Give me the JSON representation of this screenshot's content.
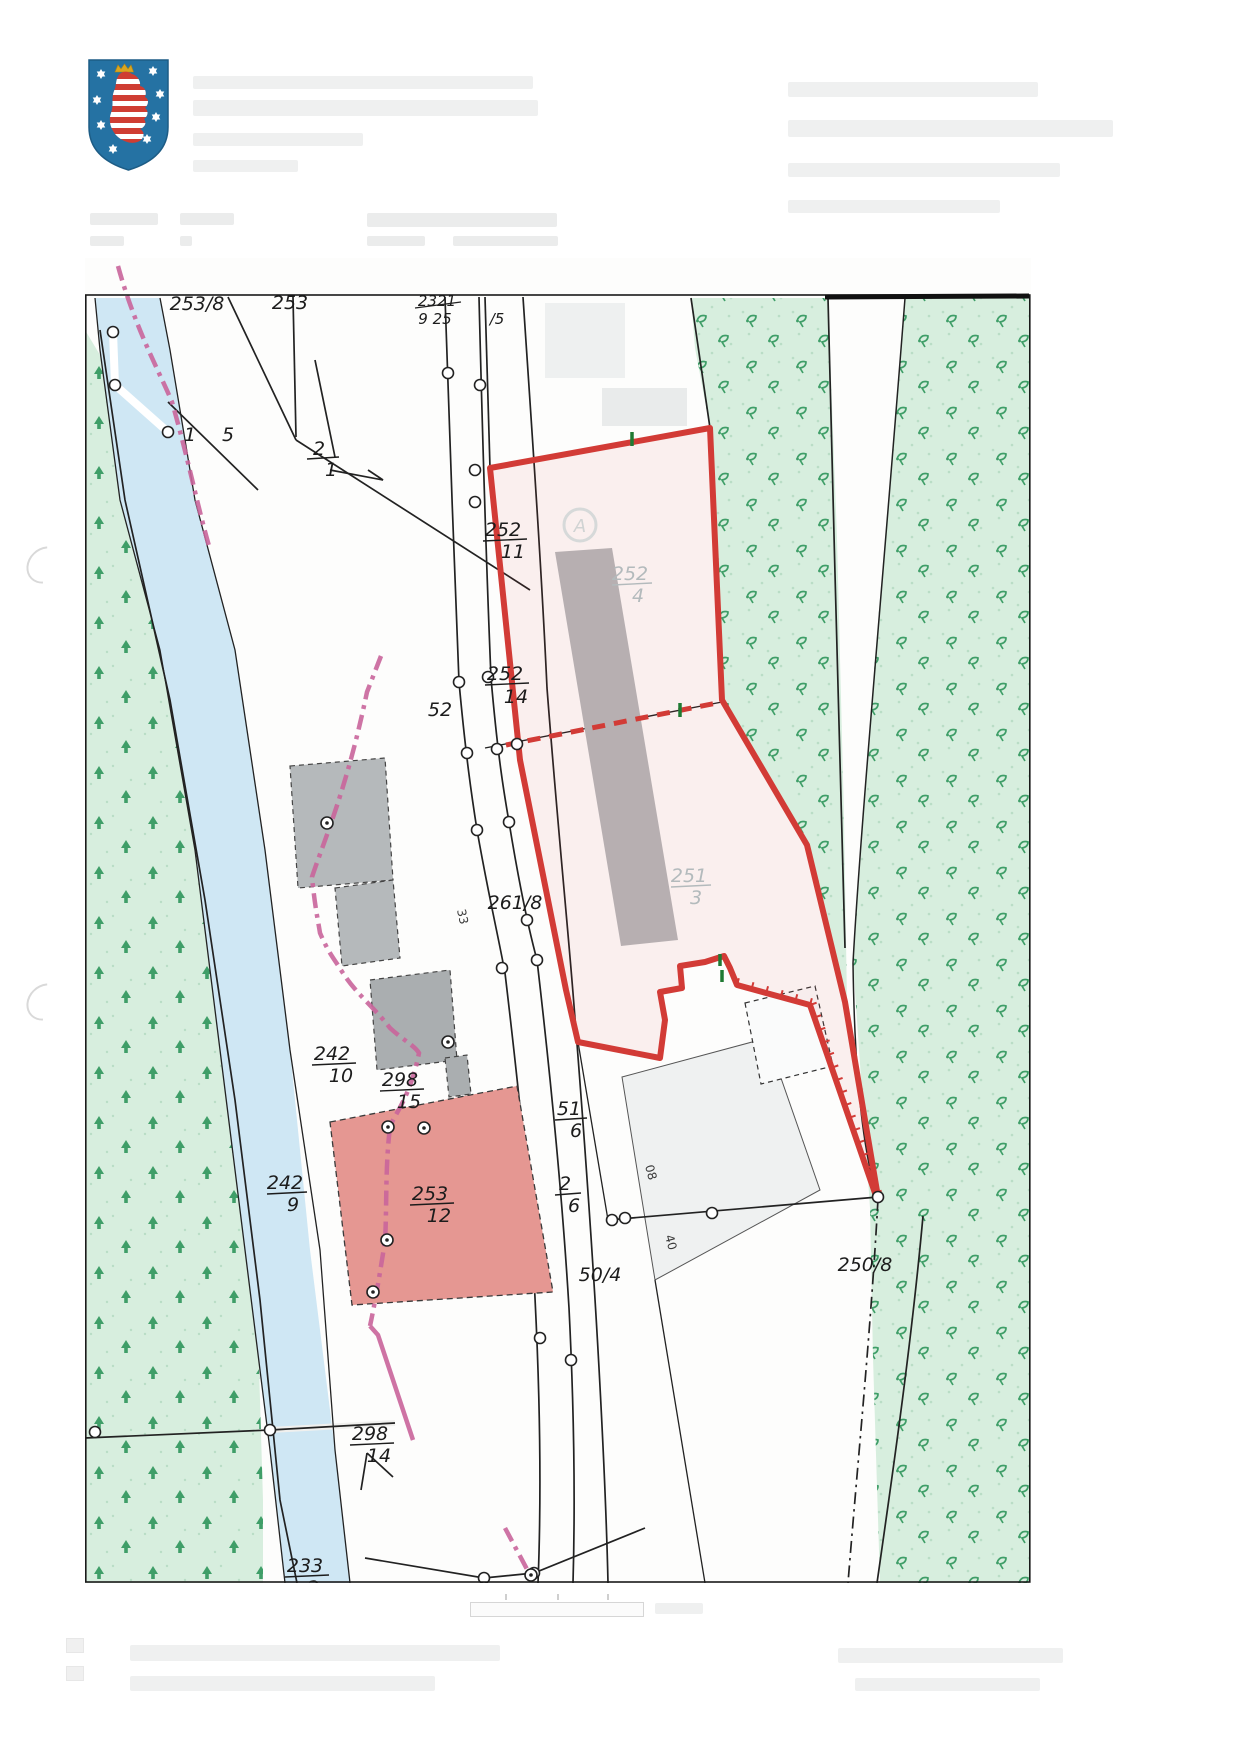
{
  "page": {
    "background": "#ffffff",
    "document_type_icon": "scanned-cadastral-map-page"
  },
  "header": {
    "coat_of_arms_icon": "thuringia-coat-of-arms",
    "text_redacted": true
  },
  "map": {
    "colors": {
      "forest_fill": "#d7eede",
      "forest_symbol_green": "#3f9e68",
      "water_fill": "#cfe7f4",
      "subject_parcel_boundary_red": "#d23b36",
      "subject_parcel_fill": "rgba(210,60,60,0.07)",
      "municipal_boundary_pink": "#c9659b",
      "building_gray": "#b5b9bb",
      "building_salmon": "#e59792",
      "label_dark": "#1c1c1c",
      "label_muted": "#b3babc"
    },
    "monument_symbol_letter": "A",
    "labels": [
      {
        "kind": "single",
        "text": "253/8"
      },
      {
        "kind": "single",
        "text": "253"
      },
      {
        "kind": "single",
        "text": "2321"
      },
      {
        "kind": "single",
        "text": "9 25"
      },
      {
        "kind": "single",
        "text": "/5"
      },
      {
        "kind": "single",
        "text": "1"
      },
      {
        "kind": "single",
        "text": "5"
      },
      {
        "kind": "fraction",
        "num": "2",
        "den": "1"
      },
      {
        "kind": "fraction",
        "num": "252",
        "den": "11"
      },
      {
        "kind": "fraction",
        "num": "252",
        "den": "4",
        "muted": true
      },
      {
        "kind": "fraction",
        "num": "252",
        "den": "14"
      },
      {
        "kind": "single",
        "text": "52"
      },
      {
        "kind": "single",
        "text": "261/8"
      },
      {
        "kind": "fraction",
        "num": "251",
        "den": "3",
        "muted": true
      },
      {
        "kind": "fraction",
        "num": "242",
        "den": "10"
      },
      {
        "kind": "fraction",
        "num": "298",
        "den": "15"
      },
      {
        "kind": "fraction",
        "num": "51",
        "den": "6"
      },
      {
        "kind": "fraction",
        "num": "2",
        "den": "6"
      },
      {
        "kind": "fraction",
        "num": "253",
        "den": "12"
      },
      {
        "kind": "single",
        "text": "250/8",
        "muted": true
      },
      {
        "kind": "single",
        "text": "50/4"
      },
      {
        "kind": "fraction",
        "num": "298",
        "den": "14"
      },
      {
        "kind": "fraction",
        "num": "233",
        "den": "2"
      },
      {
        "kind": "single",
        "text": "33",
        "rot": true
      },
      {
        "kind": "single",
        "text": "08",
        "rot": true
      },
      {
        "kind": "single",
        "text": "40",
        "rot": true
      },
      {
        "kind": "fraction",
        "num": "242",
        "den": "9"
      }
    ]
  },
  "footer": {
    "legend_redacted": true,
    "scale_bar_present": true
  }
}
